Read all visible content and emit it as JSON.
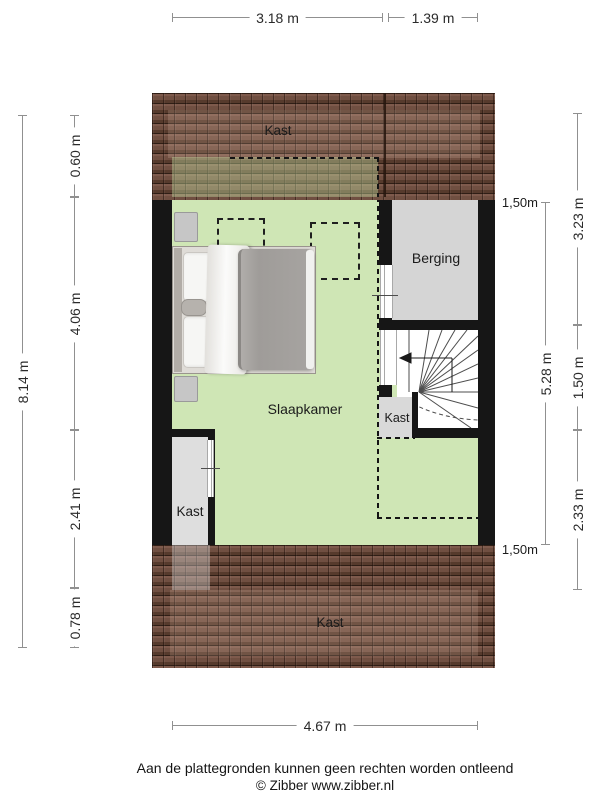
{
  "dimensions": {
    "top": [
      "3.18 m",
      "1.39 m"
    ],
    "bottom": "4.67 m",
    "left_total": "8.14 m",
    "left_segments": [
      "0.60 m",
      "4.06 m",
      "2.41 m",
      "0.78 m"
    ],
    "right_inner_total": "5.28 m",
    "right_outer_segments": [
      "3.23 m",
      "1.50 m",
      "2.33 m"
    ],
    "knee_wall_top": "1,50m",
    "knee_wall_bottom": "1,50m"
  },
  "rooms": {
    "bedroom": "Slaapkamer",
    "storage": "Berging",
    "closet_roof_top": "Kast",
    "closet_left": "Kast",
    "closet_stairs": "Kast",
    "closet_roof_bottom": "Kast"
  },
  "footer": {
    "disclaimer": "Aan de plattegronden kunnen geen rechten worden ontleend",
    "copyright": "© Zibber www.zibber.nl"
  },
  "colors": {
    "floor_green": "#cfe6b5",
    "storage_gray": "#d5d5d5",
    "closet_gray": "#dedede",
    "wall_black": "#161616",
    "roof_brown": "#8a6456",
    "dimension_line": "#909090"
  }
}
